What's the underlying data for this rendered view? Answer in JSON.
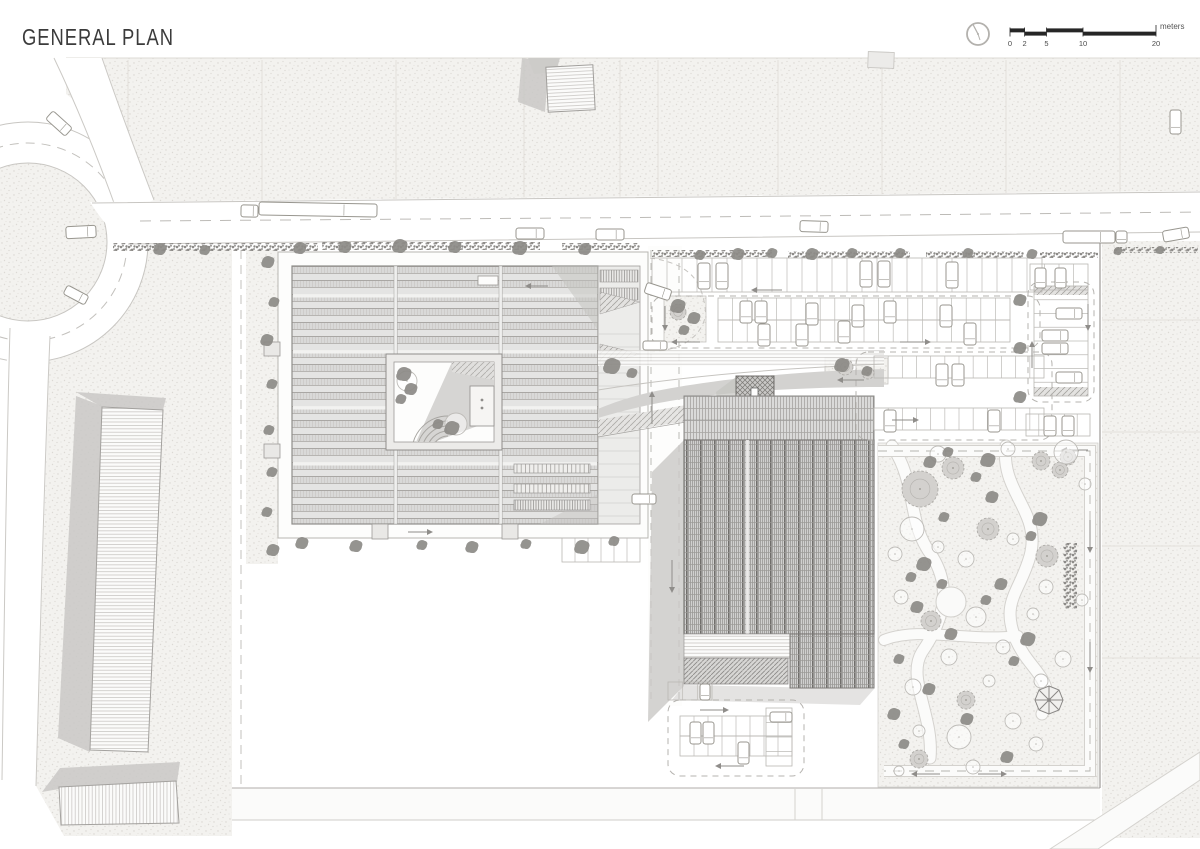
{
  "page": {
    "title": "GENERAL PLAN",
    "background": "#ffffff"
  },
  "scale_bar": {
    "unit_label": "meters",
    "tick_labels": [
      "0",
      "2",
      "5",
      "10",
      "20"
    ],
    "tick_values": [
      0,
      2,
      5,
      10,
      20
    ],
    "compass_icon": "north-indicator-circle"
  },
  "colors": {
    "ink": "#2a2a2a",
    "title_text": "#3b3b3b",
    "label_text": "#4a4a4a",
    "line_light": "#c8c6c2",
    "stipple_block": "#f3f2ef",
    "roof_fill": "#dedede",
    "shadow": "#c9c8c5",
    "hatch_dark": "#7c7a77",
    "tree_dark": "#8d8b87",
    "tree_canopy": "#d3d1ce",
    "tree_outline": "#bebcb8",
    "dash_line": "#b5b3af",
    "arrow": "#8f8d8a",
    "car_stroke": "#98968f"
  },
  "plan": {
    "trees_dark": [
      [
        160,
        249,
        6
      ],
      [
        205,
        250,
        5
      ],
      [
        300,
        248,
        6
      ],
      [
        345,
        247,
        6
      ],
      [
        400,
        246,
        7
      ],
      [
        455,
        247,
        6
      ],
      [
        520,
        248,
        7
      ],
      [
        585,
        249,
        6
      ],
      [
        700,
        255,
        5
      ],
      [
        738,
        254,
        6
      ],
      [
        772,
        253,
        5
      ],
      [
        812,
        254,
        6
      ],
      [
        852,
        253,
        5
      ],
      [
        900,
        253,
        5
      ],
      [
        968,
        253,
        5
      ],
      [
        1032,
        254,
        5
      ],
      [
        1118,
        251,
        4
      ],
      [
        1160,
        250,
        4
      ],
      [
        268,
        262,
        6
      ],
      [
        274,
        302,
        5
      ],
      [
        267,
        340,
        6
      ],
      [
        272,
        384,
        5
      ],
      [
        269,
        430,
        5
      ],
      [
        272,
        472,
        5
      ],
      [
        267,
        512,
        5
      ],
      [
        273,
        550,
        6
      ],
      [
        302,
        543,
        6
      ],
      [
        356,
        546,
        6
      ],
      [
        422,
        545,
        5
      ],
      [
        472,
        547,
        6
      ],
      [
        526,
        544,
        5
      ],
      [
        582,
        547,
        7
      ],
      [
        614,
        541,
        5
      ],
      [
        678,
        306,
        7
      ],
      [
        694,
        318,
        6
      ],
      [
        684,
        330,
        5
      ],
      [
        1020,
        300,
        6
      ],
      [
        1020,
        348,
        6
      ],
      [
        1020,
        397,
        6
      ],
      [
        612,
        366,
        8
      ],
      [
        632,
        373,
        5
      ],
      [
        842,
        365,
        7
      ],
      [
        867,
        371,
        5
      ],
      [
        404,
        374,
        7
      ],
      [
        411,
        389,
        6
      ],
      [
        401,
        399,
        5
      ],
      [
        452,
        428,
        7
      ],
      [
        438,
        424,
        5
      ],
      [
        930,
        462,
        6
      ],
      [
        948,
        452,
        5
      ],
      [
        988,
        460,
        7
      ],
      [
        976,
        477,
        5
      ],
      [
        992,
        497,
        6
      ],
      [
        944,
        517,
        5
      ],
      [
        1040,
        519,
        7
      ],
      [
        1031,
        536,
        5
      ],
      [
        924,
        564,
        7
      ],
      [
        911,
        577,
        5
      ],
      [
        1001,
        584,
        6
      ],
      [
        986,
        600,
        5
      ],
      [
        917,
        607,
        6
      ],
      [
        951,
        634,
        6
      ],
      [
        1028,
        639,
        7
      ],
      [
        899,
        659,
        5
      ],
      [
        1014,
        661,
        5
      ],
      [
        929,
        689,
        6
      ],
      [
        894,
        714,
        6
      ],
      [
        967,
        719,
        6
      ],
      [
        904,
        744,
        5
      ],
      [
        1007,
        757,
        6
      ],
      [
        942,
        584,
        5
      ]
    ],
    "trees_canopy": [
      [
        920,
        489,
        18
      ],
      [
        953,
        468,
        11
      ],
      [
        988,
        529,
        11
      ],
      [
        1047,
        556,
        11
      ],
      [
        931,
        621,
        10
      ],
      [
        966,
        700,
        9
      ],
      [
        919,
        759,
        9
      ],
      [
        1060,
        470,
        8
      ],
      [
        845,
        367,
        8
      ],
      [
        868,
        373,
        6
      ],
      [
        678,
        312,
        8
      ],
      [
        1041,
        461,
        9
      ],
      [
        1068,
        457,
        8
      ]
    ],
    "trees_outline": [
      [
        938,
        454,
        8
      ],
      [
        1008,
        449,
        7
      ],
      [
        1066,
        452,
        12
      ],
      [
        912,
        529,
        12
      ],
      [
        895,
        554,
        7
      ],
      [
        938,
        547,
        6
      ],
      [
        1013,
        539,
        6
      ],
      [
        966,
        559,
        8
      ],
      [
        1046,
        587,
        7
      ],
      [
        901,
        597,
        7
      ],
      [
        976,
        617,
        10
      ],
      [
        1033,
        614,
        6
      ],
      [
        949,
        657,
        8
      ],
      [
        1003,
        647,
        7
      ],
      [
        913,
        687,
        8
      ],
      [
        1063,
        659,
        8
      ],
      [
        1041,
        681,
        7
      ],
      [
        989,
        681,
        6
      ],
      [
        959,
        737,
        12
      ],
      [
        919,
        731,
        6
      ],
      [
        1013,
        721,
        8
      ],
      [
        899,
        771,
        5
      ],
      [
        1036,
        744,
        7
      ],
      [
        973,
        767,
        7
      ],
      [
        1085,
        484,
        6
      ],
      [
        1082,
        600,
        6
      ],
      [
        456,
        424,
        11
      ],
      [
        407,
        381,
        10
      ]
    ],
    "hedges": [
      [
        113,
        243,
        205,
        8
      ],
      [
        322,
        242,
        218,
        8
      ],
      [
        562,
        243,
        78,
        7
      ],
      [
        652,
        250,
        120,
        7
      ],
      [
        788,
        251,
        122,
        7
      ],
      [
        926,
        251,
        98,
        7
      ],
      [
        1040,
        252,
        58,
        6
      ],
      [
        1114,
        247,
        84,
        6
      ],
      [
        1063,
        543,
        14,
        66
      ]
    ],
    "cars": [
      [
        66,
        226,
        30,
        12,
        -3
      ],
      [
        241,
        205,
        17,
        12,
        1
      ],
      [
        259,
        203,
        118,
        13,
        1
      ],
      [
        516,
        228,
        28,
        11,
        0
      ],
      [
        596,
        229,
        28,
        11,
        0
      ],
      [
        800,
        221,
        28,
        11,
        2
      ],
      [
        1063,
        231,
        52,
        12,
        0
      ],
      [
        1116,
        231,
        11,
        12,
        0
      ],
      [
        1163,
        229,
        26,
        11,
        -10
      ],
      [
        1170,
        110,
        11,
        24,
        0
      ],
      [
        46,
        118,
        26,
        11,
        42
      ],
      [
        64,
        290,
        24,
        10,
        28
      ],
      [
        698,
        263,
        12,
        26,
        0
      ],
      [
        716,
        263,
        12,
        26,
        0
      ],
      [
        860,
        261,
        12,
        26,
        0
      ],
      [
        878,
        261,
        12,
        26,
        0
      ],
      [
        946,
        262,
        12,
        26,
        0
      ],
      [
        740,
        301,
        12,
        22,
        0
      ],
      [
        755,
        301,
        12,
        22,
        0
      ],
      [
        806,
        303,
        12,
        22,
        0
      ],
      [
        852,
        305,
        12,
        22,
        0
      ],
      [
        884,
        301,
        12,
        22,
        0
      ],
      [
        940,
        305,
        12,
        22,
        0
      ],
      [
        758,
        324,
        12,
        22,
        0
      ],
      [
        796,
        324,
        12,
        22,
        0
      ],
      [
        838,
        321,
        12,
        22,
        0
      ],
      [
        964,
        323,
        12,
        22,
        0
      ],
      [
        936,
        364,
        12,
        22,
        0
      ],
      [
        952,
        364,
        12,
        22,
        0
      ],
      [
        988,
        410,
        12,
        22,
        0
      ],
      [
        884,
        410,
        12,
        22,
        0
      ],
      [
        1056,
        308,
        26,
        11,
        0
      ],
      [
        1042,
        330,
        26,
        11,
        0
      ],
      [
        1042,
        343,
        26,
        11,
        0
      ],
      [
        1056,
        372,
        26,
        11,
        0
      ],
      [
        1044,
        416,
        12,
        20,
        0
      ],
      [
        1062,
        416,
        12,
        20,
        0
      ],
      [
        1035,
        268,
        11,
        20,
        0
      ],
      [
        1055,
        268,
        11,
        20,
        0
      ],
      [
        645,
        286,
        26,
        11,
        18
      ],
      [
        643,
        341,
        24,
        9,
        0
      ],
      [
        632,
        494,
        24,
        10,
        0
      ],
      [
        690,
        722,
        11,
        22,
        0
      ],
      [
        703,
        722,
        11,
        22,
        0
      ],
      [
        738,
        742,
        11,
        22,
        0
      ],
      [
        770,
        712,
        22,
        10,
        0
      ],
      [
        700,
        684,
        10,
        16,
        0
      ]
    ],
    "stall_rows": [
      [
        652,
        258,
        390,
        34,
        26,
        "v"
      ],
      [
        1030,
        264,
        58,
        26,
        4,
        "v"
      ],
      [
        718,
        298,
        292,
        22,
        20,
        "v"
      ],
      [
        718,
        320,
        292,
        22,
        20,
        "v"
      ],
      [
        874,
        356,
        170,
        22,
        12,
        "v"
      ],
      [
        874,
        408,
        170,
        22,
        12,
        "v"
      ],
      [
        1034,
        286,
        54,
        110,
        8,
        "h"
      ],
      [
        1026,
        414,
        64,
        22,
        5,
        "v"
      ],
      [
        680,
        716,
        112,
        20,
        8,
        "v"
      ],
      [
        680,
        736,
        112,
        20,
        8,
        "v"
      ],
      [
        766,
        708,
        26,
        58,
        4,
        "h"
      ],
      [
        668,
        682,
        44,
        18,
        3,
        "v"
      ],
      [
        562,
        538,
        78,
        24,
        6,
        "v"
      ]
    ],
    "aisle_loops": [
      [
        652,
        296,
        388,
        52
      ],
      [
        856,
        352,
        196,
        88
      ],
      [
        1028,
        282,
        66,
        120
      ],
      [
        668,
        700,
        136,
        76
      ]
    ],
    "arrows": [
      [
        782,
        290,
        752,
        290
      ],
      [
        900,
        342,
        930,
        342
      ],
      [
        700,
        342,
        672,
        342
      ],
      [
        1032,
        368,
        1032,
        342
      ],
      [
        1088,
        304,
        1088,
        330
      ],
      [
        864,
        380,
        838,
        380
      ],
      [
        892,
        420,
        918,
        420
      ],
      [
        672,
        560,
        672,
        592
      ],
      [
        652,
        424,
        652,
        392
      ],
      [
        1090,
        520,
        1090,
        552
      ],
      [
        1090,
        642,
        1090,
        672
      ],
      [
        940,
        774,
        912,
        774
      ],
      [
        978,
        774,
        1006,
        774
      ],
      [
        700,
        710,
        728,
        710
      ],
      [
        744,
        766,
        716,
        766
      ],
      [
        548,
        286,
        526,
        286
      ],
      [
        408,
        532,
        432,
        532
      ],
      [
        665,
        306,
        665,
        330
      ],
      [
        1088,
        450,
        1062,
        450
      ]
    ]
  }
}
